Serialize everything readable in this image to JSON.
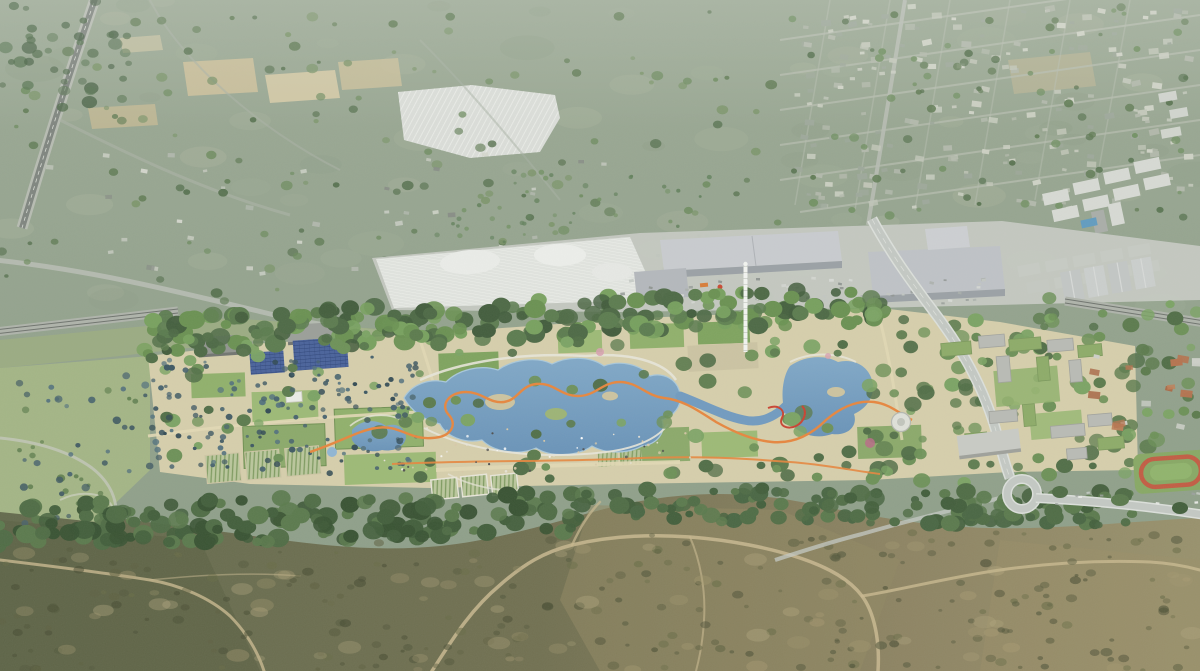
{
  "scene": {
    "description": "Aerial architectural rendering: a long linear park with lagoons, palm groves, solar arrays and lawns, bounded by a retail and industrial strip to the north and dry scrubland hills to the south",
    "landmarks": [
      {
        "name": "farmland-plain",
        "note": "sage-green agricultural plain with tan field parcels, upper left"
      },
      {
        "name": "greenhouse-field",
        "note": "white striped greenhouse parcel, upper middle left"
      },
      {
        "name": "suburb-grid",
        "note": "low-rise suburb street grid, upper right"
      },
      {
        "name": "apartment-blocks",
        "note": "white residential and industrial blocks with rooftop pool, top right"
      },
      {
        "name": "retail-warehouses",
        "note": "large grey big-box warehouse roofs and white canopy market, mid strip"
      },
      {
        "name": "observation-tower",
        "note": "tall thin white lattice tower at park centre"
      },
      {
        "name": "park-lagoons",
        "note": "chain of blue bathing lagoons with islands and white terrace walls"
      },
      {
        "name": "orange-ribbon-path",
        "note": "winding orange promenade running the length of the park"
      },
      {
        "name": "palm-grove-plaza",
        "note": "sand-coloured plaza densely planted with palms, west park"
      },
      {
        "name": "solar-arrays",
        "note": "two blue photovoltaic field grids on park roofs"
      },
      {
        "name": "allotment-gardens",
        "note": "striped community garden plots"
      },
      {
        "name": "east-campus",
        "note": "grey courtyard buildings with green roofs, road passing beneath a gateway slab"
      },
      {
        "name": "highway-loop",
        "note": "road descending through the park to a looping interchange ramp"
      },
      {
        "name": "running-track",
        "note": "red athletics track with green pitch at far right"
      },
      {
        "name": "scrubland",
        "note": "olive-brown maquis hillside with pale dirt trails, foreground"
      }
    ]
  },
  "colors": {
    "landTop": "#9ba994",
    "landMid": "#91a18b",
    "landLow": "#8b9d86",
    "fieldTan1": "#ccc09a",
    "fieldTan2": "#d6cba6",
    "fieldTan3": "#c2b893",
    "greenhouseWhite": "#dcdfda",
    "ghStripe": "#f1f3ef",
    "roadLight": "#b7bcb2",
    "asphalt": "#7e847e",
    "roadFaint": "#a8b1a3",
    "laneDash": "#d8dcd4",
    "suburbStreet": "#b6bdaf",
    "blockWhite": "#d8dbd5",
    "blockShade": "#a9ada8",
    "poolBlue": "#5f9bc0",
    "mallBase": "#c6cac3",
    "canopyWhite": "#e2e5e0",
    "whRoofA": "#c9ccd0",
    "whRoofB": "#bfc3c7",
    "whFace": "#9aa0a5",
    "whSmall": "#b4b8bc",
    "redAccent": "#c9472f",
    "railBand": "#aeb3aa",
    "railLine": "#6d726c",
    "parkBeige": "#d7cfab",
    "westGrass": "#a3b584",
    "meadow": "#9cae7e",
    "lawnA": "#8fb069",
    "lawnB": "#9cba74",
    "lawnC": "#7da35c",
    "lawnD": "#8aa968",
    "hedge": "#6e8f50",
    "plazaGrey": "#ccc4a2",
    "plotBase": "#bac79b",
    "plotStripe": "#7d9a5e",
    "wallLight": "#e9e7da",
    "solarBlue": "#46609a",
    "solarLine": "#22396e",
    "waterDeep": "#6f9ac0",
    "waterLite": "#8fb6d4",
    "waterEdge": "#a8c8dc",
    "island": "#cdc49f",
    "ribbonOrange": "#e8853b",
    "slideRed": "#c9402e",
    "towerWhite": "#f4f6f2",
    "campusBldg": "#b9bbb5",
    "campusShade": "#9ea09a",
    "greenRoof": "#8cab66",
    "slabGrey": "#c9cbc5",
    "discWhite": "#e0e2da",
    "discRing": "#b4b8b0",
    "pitchGreen": "#86a862",
    "trackRed": "#c25a40",
    "pitchInner": "#8fb46a",
    "scrubL": "#61684a",
    "scrubM": "#6f6e4e",
    "scrubR": "#97906a",
    "trail": "#c9b98f",
    "shedGrey": "#90948e",
    "shedGrey2": "#9a9e98",
    "roadPark": "#c4c9c4",
    "roadEdge": "#dde1dc",
    "pinkBloom": "#d8a0b0",
    "pinkDark": "#b86a86"
  },
  "scatter": [
    {
      "name": "field-mottle",
      "type": "rect",
      "x": 0,
      "y": 0,
      "w": 1200,
      "h": 310,
      "count": 70,
      "rmin": 10,
      "rmax": 30,
      "ry": 0.45,
      "opacity": 0.2,
      "palette": [
        "#a6b29b",
        "#8b9b83",
        "#b6bea6"
      ]
    },
    {
      "name": "top-trees",
      "type": "rect",
      "x": 0,
      "y": 12,
      "w": 780,
      "h": 290,
      "count": 150,
      "rmin": 2,
      "rmax": 6,
      "ry": 0.8,
      "opacity": 0.75,
      "palette": [
        "#5e7a52",
        "#6b8a5c",
        "#506c48",
        "#7a9468"
      ]
    },
    {
      "name": "topleft-dark",
      "type": "rect",
      "x": 0,
      "y": 0,
      "w": 130,
      "h": 110,
      "count": 40,
      "rmin": 3,
      "rmax": 8,
      "ry": 0.8,
      "opacity": 0.65,
      "palette": [
        "#4c6847",
        "#567450",
        "#3f5a3c"
      ]
    },
    {
      "name": "suburb-houses",
      "type": "rect",
      "x": 792,
      "y": 5,
      "w": 400,
      "h": 205,
      "count": 210,
      "rmin": 2,
      "rmax": 5,
      "opacity": 0.9,
      "shape": "rect",
      "palette": [
        "#b2b9ab",
        "#c3c8ba",
        "#9da89a",
        "#cfd3c6"
      ]
    },
    {
      "name": "suburb-trees",
      "type": "rect",
      "x": 792,
      "y": 5,
      "w": 405,
      "h": 215,
      "count": 80,
      "rmin": 2,
      "rmax": 5,
      "ry": 0.85,
      "opacity": 0.8,
      "palette": [
        "#5e7a52",
        "#6f8f60",
        "#54704c"
      ]
    },
    {
      "name": "orchard-west",
      "type": "rect",
      "x": 430,
      "y": 170,
      "w": 280,
      "h": 90,
      "count": 55,
      "rmin": 1.5,
      "rmax": 3,
      "ry": 0.9,
      "opacity": 0.7,
      "palette": [
        "#61805a",
        "#6f8f60",
        "#587a52"
      ]
    },
    {
      "name": "rural-buildings",
      "type": "rect",
      "x": 20,
      "y": 150,
      "w": 610,
      "h": 130,
      "count": 38,
      "rmin": 2,
      "rmax": 4,
      "opacity": 0.85,
      "shape": "rect",
      "palette": [
        "#c8ccc2",
        "#b4bab0",
        "#878d85",
        "#d4d7cd"
      ]
    },
    {
      "name": "mall-cars",
      "type": "rect",
      "x": 615,
      "y": 278,
      "w": 370,
      "h": 26,
      "count": 55,
      "rmin": 1.4,
      "rmax": 2.4,
      "opacity": 0.85,
      "shape": "rect",
      "palette": [
        "#d8dbd6",
        "#aab0ab",
        "#8f9591",
        "#c2c7c2"
      ]
    },
    {
      "name": "scrub-blobs",
      "type": "rect",
      "x": 0,
      "y": 532,
      "w": 1200,
      "h": 139,
      "count": 260,
      "rmin": 2,
      "rmax": 6,
      "ry": 0.7,
      "opacity": 0.5,
      "palette": [
        "#4f5438",
        "#5c5e3e",
        "#454a30",
        "#666a44"
      ]
    },
    {
      "name": "scrub-light",
      "type": "rect",
      "x": 0,
      "y": 545,
      "w": 1200,
      "h": 126,
      "count": 70,
      "rmin": 4,
      "rmax": 12,
      "ry": 0.55,
      "opacity": 0.28,
      "palette": [
        "#b0a277",
        "#c0b288",
        "#a79a70"
      ]
    },
    {
      "name": "park-canopy",
      "type": "band",
      "x0": 145,
      "y0": 336,
      "x1": 880,
      "y1": 303,
      "th": 38,
      "count": 220,
      "rmin": 5,
      "rmax": 11,
      "ry": 0.85,
      "opacity": 1,
      "palette": [
        "#4a6742",
        "#597a4c",
        "#68904f",
        "#76a05c",
        "#3f5a39"
      ]
    },
    {
      "name": "park-trees",
      "type": "rect",
      "x": 150,
      "y": 332,
      "w": 990,
      "h": 148,
      "count": 120,
      "rmin": 4,
      "rmax": 9,
      "ry": 0.85,
      "opacity": 0.95,
      "palette": [
        "#59794a",
        "#6b9055",
        "#7aa362",
        "#4e6c44"
      ]
    },
    {
      "name": "palm-grove",
      "type": "rect",
      "x": 150,
      "y": 356,
      "w": 266,
      "h": 120,
      "count": 150,
      "rmin": 1.6,
      "rmax": 3.4,
      "ry": 0.9,
      "opacity": 0.85,
      "palette": [
        "#44606c",
        "#3a5560",
        "#2f4852",
        "#51707c"
      ]
    },
    {
      "name": "palms-west",
      "type": "rect",
      "x": 15,
      "y": 375,
      "w": 135,
      "h": 150,
      "count": 50,
      "rmin": 2,
      "rmax": 4.5,
      "ry": 0.9,
      "opacity": 0.8,
      "palette": [
        "#44606c",
        "#3a5560",
        "#5d7d4c",
        "#51707c"
      ]
    },
    {
      "name": "right-trees",
      "type": "rect",
      "x": 855,
      "y": 298,
      "w": 345,
      "h": 185,
      "count": 110,
      "rmin": 4,
      "rmax": 9,
      "ry": 0.85,
      "opacity": 0.9,
      "palette": [
        "#59794a",
        "#6b9055",
        "#4e6c44",
        "#7aa362"
      ]
    },
    {
      "name": "village-houses",
      "type": "rect",
      "x": 1088,
      "y": 352,
      "w": 110,
      "h": 86,
      "count": 16,
      "rmin": 3,
      "rmax": 6,
      "opacity": 0.95,
      "shape": "rect",
      "palette": [
        "#b5714c",
        "#c07e56",
        "#a96844",
        "#cdd0c8"
      ]
    },
    {
      "name": "fringe-west",
      "type": "band",
      "x0": 0,
      "y0": 524,
      "x1": 575,
      "y1": 514,
      "th": 46,
      "count": 170,
      "rmin": 5,
      "rmax": 11,
      "ry": 0.85,
      "opacity": 1,
      "palette": [
        "#3f5c38",
        "#4c6a42",
        "#58784a",
        "#35502f"
      ]
    },
    {
      "name": "fringe-east",
      "type": "band",
      "x0": 575,
      "y0": 503,
      "x1": 1135,
      "y1": 509,
      "th": 34,
      "count": 140,
      "rmin": 4,
      "rmax": 10,
      "ry": 0.85,
      "opacity": 1,
      "palette": [
        "#3f5c38",
        "#4c6a42",
        "#58784a",
        "#466440"
      ]
    },
    {
      "name": "plaza-people",
      "type": "rect",
      "x": 360,
      "y": 428,
      "w": 330,
      "h": 44,
      "count": 45,
      "rmin": 0.8,
      "rmax": 1.4,
      "ry": 1,
      "opacity": 0.9,
      "palette": [
        "#ffffff",
        "#e8e4d8",
        "#4a4a4a",
        "#d9c9a8"
      ]
    },
    {
      "name": "road-cars",
      "type": "rect",
      "x": 1050,
      "y": 492,
      "w": 150,
      "h": 14,
      "count": 10,
      "rmin": 1.5,
      "rmax": 2.4,
      "opacity": 0.9,
      "shape": "rect",
      "palette": [
        "#e8eae6",
        "#9aa09b",
        "#c6cbc5"
      ]
    }
  ]
}
